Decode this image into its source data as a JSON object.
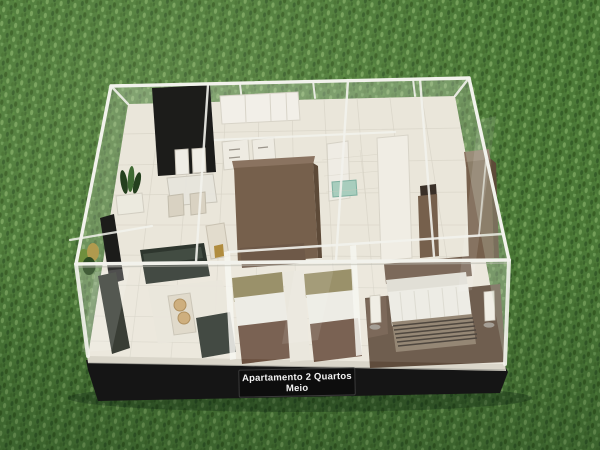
{
  "scene": {
    "type": "photograph",
    "subject": "architectural scale model (maquete) of a 2-bedroom apartment with transparent acrylic walls, displayed on artificial grass",
    "label": {
      "line1": "Apartamento 2 Quartos",
      "line2": "Meio"
    },
    "objects": [
      "artificial-grass-ground",
      "black-plinth-base",
      "name-plate",
      "acrylic-outer-walls",
      "tiled-floor",
      "black-feature-wall",
      "kitchen-cabinets",
      "dining-table-with-chairs",
      "living-room-sofa",
      "tv-panel",
      "coffee-table",
      "balcony-plants",
      "bathroom-with-green-glass",
      "twin-bed-bedroom",
      "double-bed-bedroom",
      "slatted-bench",
      "bedside-lamps",
      "brown-wardrobes"
    ]
  },
  "colors": {
    "grass_base": "#4c7a38",
    "grass_dark": "#2f5526",
    "grass_light": "#7aa55e",
    "base_black": "#151515",
    "base_highlight": "#dad6ca",
    "floor": "#eae6da",
    "acrylic_edge": "#f2f2ec",
    "acrylic_tint": "#cfdcc8",
    "wood_brown": "#76604c",
    "wood_brown_dark": "#5d4a38",
    "feature_black": "#1c1c1a",
    "sofa_dark": "#2e362e",
    "bedding_white": "#ebeae2",
    "headboard_olive": "#8f855a",
    "glass_teal": "#a8cdbd",
    "label_bg": "#0d0d0d",
    "label_text": "#f2f2f2"
  }
}
